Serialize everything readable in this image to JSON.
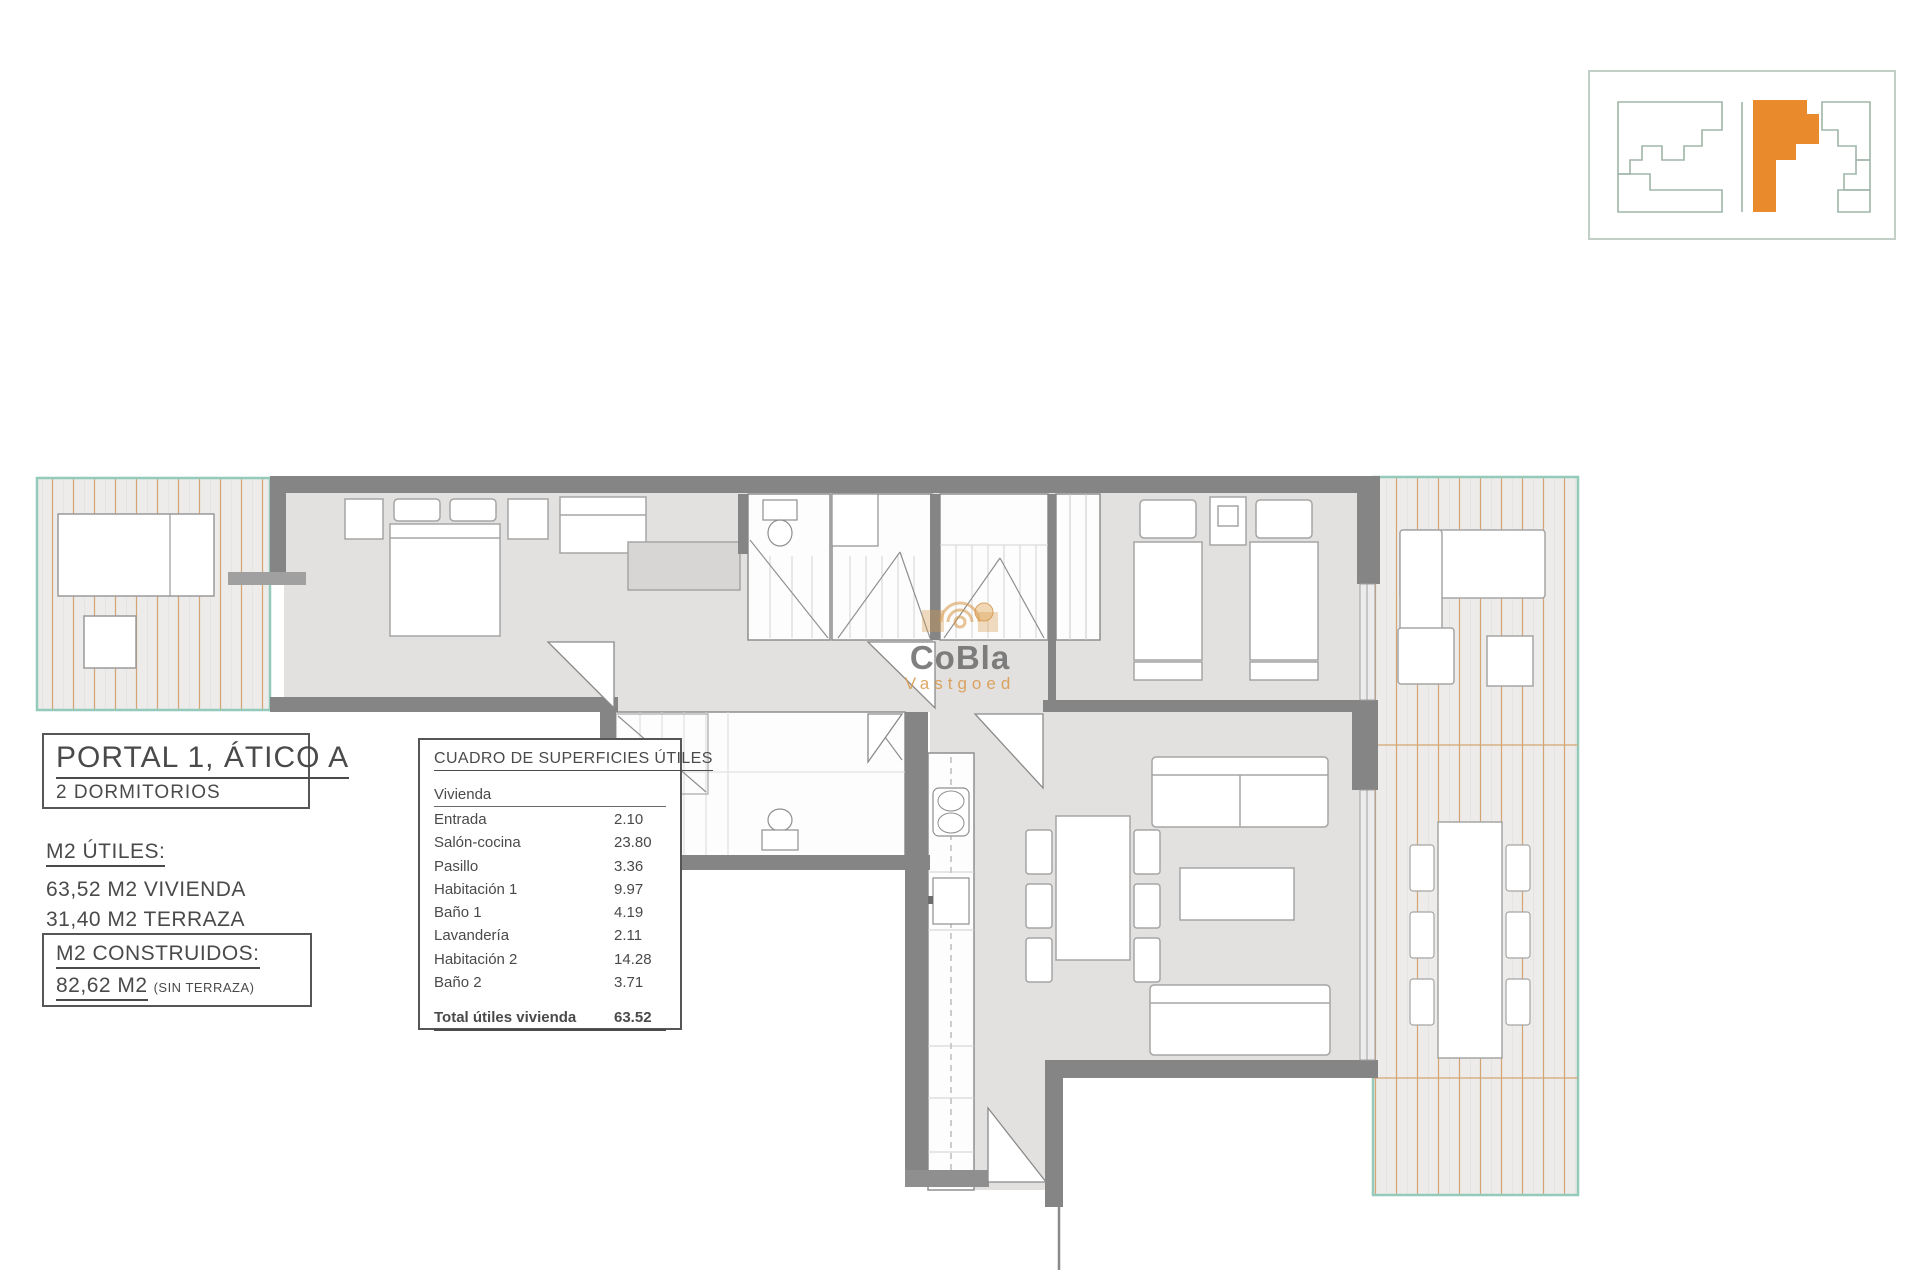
{
  "plan_title": {
    "line1": "PORTAL 1, ÁTICO A",
    "line2": "2 DORMITORIOS"
  },
  "areas_utiles": {
    "heading": "M2 ÚTILES:",
    "line1": "63,52 M2 VIVIENDA",
    "line2": "31,40 M2 TERRAZA"
  },
  "areas_construidos": {
    "heading": "M2 CONSTRUIDOS:",
    "value": "82,62 M2",
    "note": "(SIN TERRAZA)"
  },
  "surface_table": {
    "title": "CUADRO DE SUPERFICIES ÚTILES",
    "group_label": "Vivienda",
    "rows": [
      {
        "label": "Entrada",
        "value": "2.10"
      },
      {
        "label": "Salón-cocina",
        "value": "23.80"
      },
      {
        "label": "Pasillo",
        "value": "3.36"
      },
      {
        "label": "Habitación 1",
        "value": "9.97"
      },
      {
        "label": "Baño 1",
        "value": "4.19"
      },
      {
        "label": "Lavandería",
        "value": "2.11"
      },
      {
        "label": "Habitación 2",
        "value": "14.28"
      },
      {
        "label": "Baño 2",
        "value": "3.71"
      }
    ],
    "total_label": "Total útiles vivienda",
    "total_value": "63.52"
  },
  "watermark": {
    "brand": "CoBla",
    "subbrand": "Vastgoed"
  },
  "colors": {
    "accent_orange": "#e98b2d",
    "deck_stripe": "#d4a572",
    "terrace_border": "#93cabc",
    "wall_gray": "#858585",
    "floor_gray": "#e3e1df",
    "watermark_orange": "#d89a4e",
    "text_gray": "#4f4f4f"
  }
}
